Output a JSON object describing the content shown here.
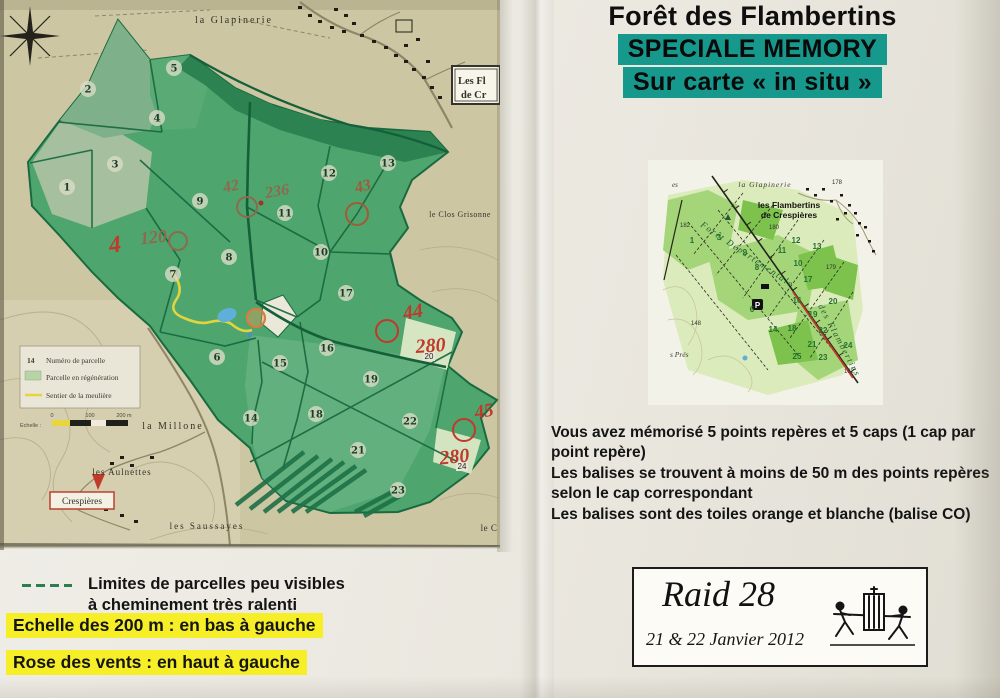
{
  "header": {
    "title": "Forêt des Flambertins",
    "subtitle1": "SPECIALE MEMORY",
    "subtitle2": "Sur carte « in situ »",
    "highlight_color": "#17988d"
  },
  "instructions": {
    "p1": "Vous avez mémorisé 5 points repères et 5 caps (1 cap par point repère)",
    "p2": "Les balises se trouvent à moins de 50 m des points repères selon le cap correspondant",
    "p3": "Les balises sont des toiles orange et blanche (balise CO)"
  },
  "raid_box": {
    "title": "Raid 28",
    "date": "21 & 22 Janvier 2012"
  },
  "footer_notes": {
    "limites_l1": "Limites de parcelles peu visibles",
    "limites_l2": "à cheminement très ralenti",
    "echelle": "Echelle des 200 m : en bas à gauche",
    "rose": "Rose des vents : en haut à gauche",
    "highlight_color": "#f6ee27"
  },
  "big_map": {
    "place_labels": [
      {
        "text": "la Glapinerie",
        "x": 234,
        "y": 23,
        "size": 10,
        "ls": 2
      },
      {
        "text": "le Clos Grisonne",
        "x": 460,
        "y": 217,
        "size": 8,
        "ls": 0.5
      },
      {
        "text": "la Millone",
        "x": 173,
        "y": 429,
        "size": 10,
        "ls": 2
      },
      {
        "text": "les Aulnettes",
        "x": 122,
        "y": 475,
        "size": 9,
        "ls": 1
      },
      {
        "text": "les Saussayes",
        "x": 207,
        "y": 529,
        "size": 9,
        "ls": 2
      },
      {
        "text": "le C",
        "x": 489,
        "y": 531,
        "size": 9,
        "ls": 0.5
      }
    ],
    "crespieres_label": "Crespières",
    "cut_box": {
      "l1": "Les Fl",
      "l2": "de Cr"
    },
    "legend": {
      "num": "14",
      "row1": "Numéro de parcelle",
      "row2": "Parcelle en régénération",
      "row3": "Sentier de la meulière",
      "scale_label": "Echelle :",
      "t0": "0",
      "t100": "100",
      "t200": "200 m"
    },
    "parcel_circles": [
      {
        "n": "1",
        "x": 67,
        "y": 187
      },
      {
        "n": "2",
        "x": 88,
        "y": 89
      },
      {
        "n": "3",
        "x": 115,
        "y": 164
      },
      {
        "n": "4",
        "x": 157,
        "y": 118
      },
      {
        "n": "5",
        "x": 174,
        "y": 68
      },
      {
        "n": "6",
        "x": 217,
        "y": 357
      },
      {
        "n": "7",
        "x": 173,
        "y": 274
      },
      {
        "n": "8",
        "x": 229,
        "y": 257
      },
      {
        "n": "9",
        "x": 200,
        "y": 201
      },
      {
        "n": "10",
        "x": 321,
        "y": 252
      },
      {
        "n": "11",
        "x": 285,
        "y": 213
      },
      {
        "n": "12",
        "x": 329,
        "y": 173
      },
      {
        "n": "13",
        "x": 388,
        "y": 163
      },
      {
        "n": "14",
        "x": 251,
        "y": 418
      },
      {
        "n": "15",
        "x": 280,
        "y": 363
      },
      {
        "n": "16",
        "x": 327,
        "y": 348
      },
      {
        "n": "17",
        "x": 346,
        "y": 293
      },
      {
        "n": "18",
        "x": 316,
        "y": 414
      },
      {
        "n": "19",
        "x": 371,
        "y": 379
      },
      {
        "n": "21",
        "x": 358,
        "y": 450
      },
      {
        "n": "22",
        "x": 410,
        "y": 421
      },
      {
        "n": "23",
        "x": 398,
        "y": 490
      }
    ],
    "plain_numbers": [
      {
        "t": "20",
        "x": 429,
        "y": 359
      },
      {
        "t": "24",
        "x": 462,
        "y": 469
      }
    ],
    "red_texts": [
      {
        "t": "4",
        "x": 116,
        "y": 252,
        "s": 24,
        "c": "#c0392b",
        "rot": -8
      },
      {
        "t": "120",
        "x": 154,
        "y": 243,
        "s": 18,
        "c": "#8d6a4e",
        "rot": -6
      },
      {
        "t": "42",
        "x": 232,
        "y": 191,
        "s": 16,
        "c": "#8d6a4e",
        "rot": -12
      },
      {
        "t": "236",
        "x": 278,
        "y": 196,
        "s": 16,
        "c": "#8d6a4e",
        "rot": -10
      },
      {
        "t": "43",
        "x": 364,
        "y": 191,
        "s": 16,
        "c": "#a35a36",
        "rot": -14
      },
      {
        "t": "44",
        "x": 414,
        "y": 318,
        "s": 20,
        "c": "#c0392b",
        "rot": -10
      },
      {
        "t": "280",
        "x": 431,
        "y": 352,
        "s": 20,
        "c": "#c0392b",
        "rot": -4
      },
      {
        "t": "45",
        "x": 485,
        "y": 417,
        "s": 19,
        "c": "#c0392b",
        "rot": -10
      },
      {
        "t": "280",
        "x": 455,
        "y": 463,
        "s": 20,
        "c": "#c0392b",
        "rot": -6
      }
    ],
    "red_circles": [
      {
        "x": 178,
        "y": 241,
        "r": 9,
        "c": "#8d6a4e"
      },
      {
        "x": 247,
        "y": 207,
        "r": 10,
        "c": "#8d6a4e"
      },
      {
        "x": 357,
        "y": 214,
        "r": 11,
        "c": "#a35a36"
      },
      {
        "x": 387,
        "y": 331,
        "r": 11,
        "c": "#c0392b"
      },
      {
        "x": 464,
        "y": 430,
        "r": 11,
        "c": "#c0392b"
      }
    ]
  },
  "small_map": {
    "labels": [
      {
        "text": "es",
        "x": 24,
        "y": 27,
        "size": 7,
        "cls": "sm-it",
        "anchor": "start"
      },
      {
        "text": "la Glapinerie",
        "x": 117,
        "y": 27,
        "size": 7.5,
        "cls": "sm-it",
        "anchor": "middle",
        "ls": 1
      },
      {
        "text": "les Flambertins",
        "x": 141,
        "y": 48,
        "size": 8.5,
        "cls": "sm-bold",
        "anchor": "middle"
      },
      {
        "text": "de Crespières",
        "x": 141,
        "y": 58,
        "size": 8.5,
        "cls": "sm-bold",
        "anchor": "middle"
      },
      {
        "text": "s Prés",
        "x": 22,
        "y": 197,
        "size": 7.5,
        "cls": "sm-it",
        "anchor": "start"
      }
    ],
    "rotated": [
      {
        "text": "Forêt Départementale",
        "x": 52,
        "y": 66,
        "rot": 34,
        "size": 9
      },
      {
        "text": "des Flambertins",
        "x": 170,
        "y": 146,
        "rot": 62,
        "size": 9
      }
    ],
    "parcels": [
      {
        "t": "1",
        "x": 44,
        "y": 83
      },
      {
        "t": "3",
        "x": 71,
        "y": 80
      },
      {
        "t": "9",
        "x": 97,
        "y": 95
      },
      {
        "t": "12",
        "x": 148,
        "y": 83
      },
      {
        "t": "11",
        "x": 134,
        "y": 93
      },
      {
        "t": "13",
        "x": 169,
        "y": 89
      },
      {
        "t": "10",
        "x": 150,
        "y": 106
      },
      {
        "t": "8",
        "x": 109,
        "y": 110
      },
      {
        "t": "17",
        "x": 160,
        "y": 122
      },
      {
        "t": "16",
        "x": 149,
        "y": 143
      },
      {
        "t": "20",
        "x": 185,
        "y": 144
      },
      {
        "t": "19",
        "x": 165,
        "y": 157
      },
      {
        "t": "6",
        "x": 104,
        "y": 152
      },
      {
        "t": "14",
        "x": 125,
        "y": 172
      },
      {
        "t": "18",
        "x": 144,
        "y": 171
      },
      {
        "t": "22",
        "x": 175,
        "y": 173
      },
      {
        "t": "21",
        "x": 164,
        "y": 187
      },
      {
        "t": "24",
        "x": 200,
        "y": 188
      },
      {
        "t": "25",
        "x": 149,
        "y": 199
      },
      {
        "t": "23",
        "x": 175,
        "y": 200
      }
    ],
    "elevations": [
      {
        "t": "178",
        "x": 184,
        "y": 24
      },
      {
        "t": "182",
        "x": 32,
        "y": 67
      },
      {
        "t": "180",
        "x": 121,
        "y": 69
      },
      {
        "t": "179",
        "x": 178,
        "y": 109
      },
      {
        "t": "148",
        "x": 43,
        "y": 165
      },
      {
        "t": "162",
        "x": 196,
        "y": 213
      }
    ],
    "parking": "P"
  }
}
